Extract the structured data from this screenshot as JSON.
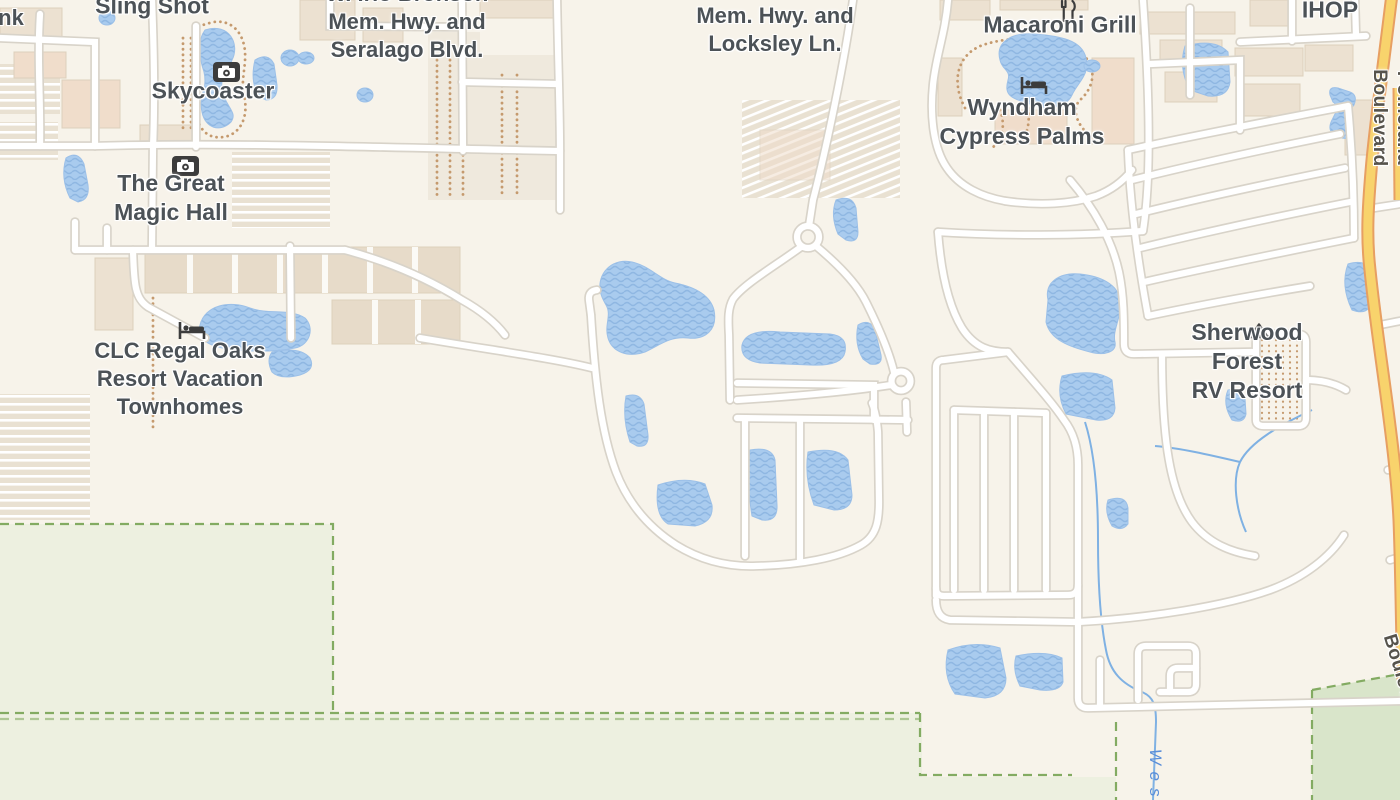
{
  "map": {
    "description": "Street map of the Kissimmee FL resort area near W. Irlo Bronson Memorial Highway and Poinciana Boulevard",
    "labels": [
      {
        "id": "partial-bank",
        "text": "nk",
        "x": 11,
        "y": 18,
        "size": 22,
        "rotate": 0,
        "type": "poi"
      },
      {
        "id": "sling-shot",
        "text": "Sling Shot",
        "x": 152,
        "y": 6,
        "size": 23,
        "rotate": 0,
        "type": "poi"
      },
      {
        "id": "skycoaster",
        "text": "Skycoaster",
        "x": 213,
        "y": 91,
        "size": 23,
        "rotate": 0,
        "type": "poi"
      },
      {
        "id": "great-magic-hall",
        "text": "The Great\nMagic Hall",
        "x": 171,
        "y": 198,
        "size": 23,
        "rotate": 0,
        "type": "poi"
      },
      {
        "id": "clc-regal-oaks",
        "text": "CLC Regal Oaks\nResort Vacation\nTownhomes",
        "x": 180,
        "y": 379,
        "size": 22,
        "rotate": 0,
        "type": "poi"
      },
      {
        "id": "irlo-seralago",
        "text": "W. Irlo Bronson\nMem. Hwy. and\nSeralago Blvd.",
        "x": 407,
        "y": 22,
        "size": 22,
        "rotate": 0,
        "type": "poi"
      },
      {
        "id": "irlo-locksley",
        "text": "W. Irlo Bronson\nMem. Hwy. and\nLocksley Ln.",
        "x": 775,
        "y": 16,
        "size": 22,
        "rotate": 0,
        "type": "poi"
      },
      {
        "id": "macaroni-grill",
        "text": "Macaroni Grill",
        "x": 1060,
        "y": 25,
        "size": 23,
        "rotate": 0,
        "type": "poi"
      },
      {
        "id": "wyndham-cypress-palms",
        "text": "Wyndham\nCypress Palms",
        "x": 1022,
        "y": 122,
        "size": 23,
        "rotate": 0,
        "type": "poi"
      },
      {
        "id": "ihop",
        "text": "IHOP",
        "x": 1330,
        "y": 10,
        "size": 23,
        "rotate": 0,
        "type": "poi"
      },
      {
        "id": "sherwood-forest",
        "text": "Sherwood Forest\nRV Resort",
        "x": 1247,
        "y": 362,
        "size": 23,
        "rotate": 0,
        "type": "poi"
      },
      {
        "id": "poinciana-blvd-north",
        "text": "Poinciana Boulevard",
        "x": 1391,
        "y": 118,
        "size": 19,
        "rotate": 90,
        "type": "road"
      },
      {
        "id": "poinciana-blvd-south",
        "text": "Poinciana Boulevard",
        "x": 1414,
        "y": 678,
        "size": 19,
        "rotate": 73,
        "type": "road"
      },
      {
        "id": "west-waterway",
        "text": "West",
        "x": 1155,
        "y": 782,
        "size": 17,
        "rotate": 90,
        "type": "water"
      }
    ],
    "icons": [
      {
        "type": "camera",
        "x": 213,
        "y": 62
      },
      {
        "type": "camera",
        "x": 172,
        "y": 156
      },
      {
        "type": "hotel",
        "x": 178,
        "y": 320
      },
      {
        "type": "hotel",
        "x": 1020,
        "y": 75
      },
      {
        "type": "restaurant",
        "x": 1059,
        "y": 0
      },
      {
        "type": "campground",
        "x": 1246,
        "y": 322
      }
    ],
    "colors": {
      "background": "#f7f3ea",
      "water": "#a9cbee",
      "waterWave": "#8fb7e2",
      "stream": "#7fb1e3",
      "roadFill": "#ffffff",
      "roadCasing": "#d8d3c9",
      "highwayFill": "#f8d36c",
      "highwayCasing": "#e79f62",
      "building": "#ece1d1",
      "buildingPink": "#f0ddcb",
      "lot": "#efe9dd",
      "park": "#edf0e0",
      "parkDark": "#d9e5ca",
      "parkBoundary": "#83ab62",
      "trail": "#c59a6e",
      "poiLabel": "#4c5257",
      "roadLabel": "#56534c",
      "waterLabel": "#5b8fd9",
      "iconDark": "#3c3c3c"
    }
  }
}
